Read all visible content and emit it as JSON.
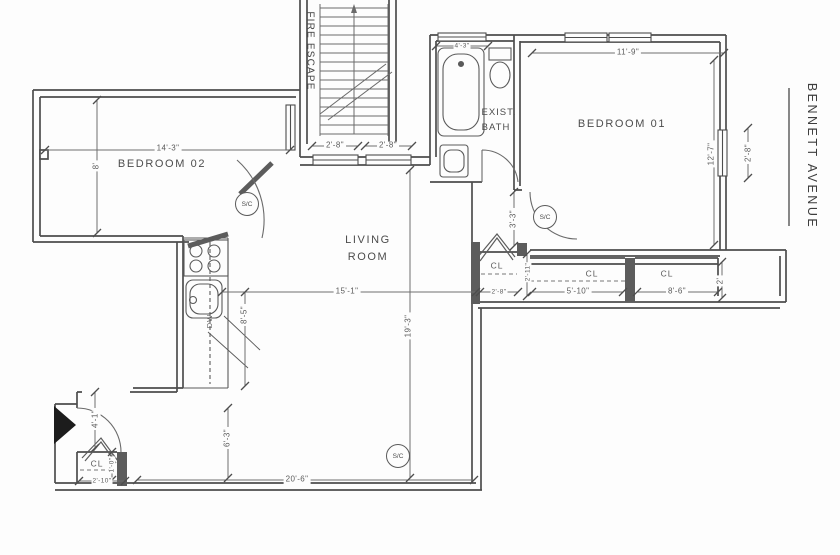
{
  "drawing": {
    "street": "BENNETT AVENUE",
    "fire_escape": "FIRE ESCAPE",
    "rooms": {
      "bedroom02": "BEDROOM 02",
      "bedroom01": "BEDROOM 01",
      "living1": "LIVING",
      "living2": "ROOM",
      "bath1": "EXIST.",
      "bath2": "BATH",
      "cl": "CL",
      "dw": "DW"
    },
    "marker_sc": "S/C",
    "dims": {
      "bed02_w": "14'-3\"",
      "bed02_h": "8'",
      "lr_win1": "2'-8\"",
      "lr_win2": "2'-8\"",
      "bed01_w": "11'-9\"",
      "bed01_h": "12'-7\"",
      "bed01_win": "2'-8\"",
      "bath_w": "4'-3\"",
      "bed01_door": "3'-3\"",
      "lr_w": "15'-1\"",
      "lr_h": "19'-3\"",
      "kitchen": "8'-5\"",
      "cl1_w": "2'-8\"",
      "cl1_h": "2'-11\"",
      "cl2_w": "5'-10\"",
      "cl3_w": "8'-6\"",
      "cl_d": "2'",
      "entry_h": "6'-3\"",
      "lr_bottom": "20'-6\"",
      "vest_h": "4'-1\"",
      "vcl_w": "2'-10\"",
      "vcl_d": "1'-0\""
    }
  }
}
